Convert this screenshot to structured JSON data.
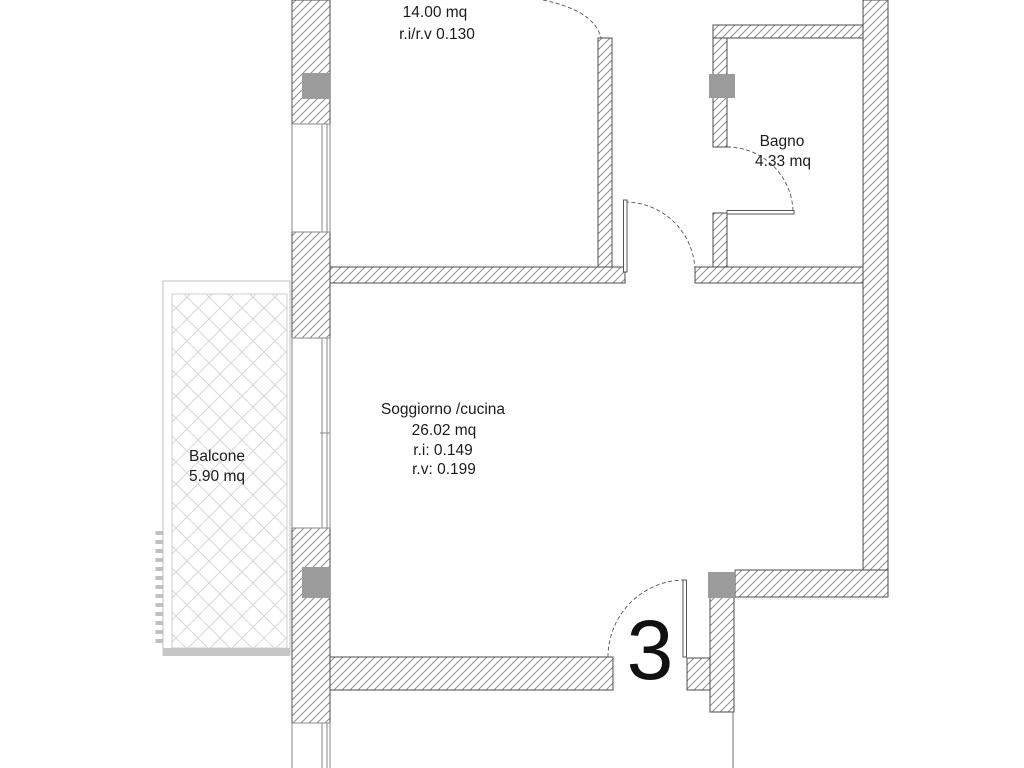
{
  "unit_number": "3",
  "rooms": {
    "camera": {
      "area": "14.00 mq",
      "ratio": "r.i/r.v 0.130"
    },
    "bagno": {
      "name": "Bagno",
      "area": "4.33 mq"
    },
    "soggiorno": {
      "name": "Soggiorno /cucina",
      "area": "26.02 mq",
      "ri": "r.i: 0.149",
      "rv": "r.v: 0.199"
    },
    "balcone": {
      "name": "Balcone",
      "area": "5.90 mq"
    }
  },
  "colors": {
    "wall_hatch_line": "#8f8f8f",
    "wall_border": "#4d4d4d",
    "pillar_fill": "#9b9b9b",
    "balcony_hatch_line": "#d8d8d8",
    "balcony_edge_strip": "#c6c6c6",
    "door_arc": "#555555",
    "label_text": "#1c1c1c"
  }
}
